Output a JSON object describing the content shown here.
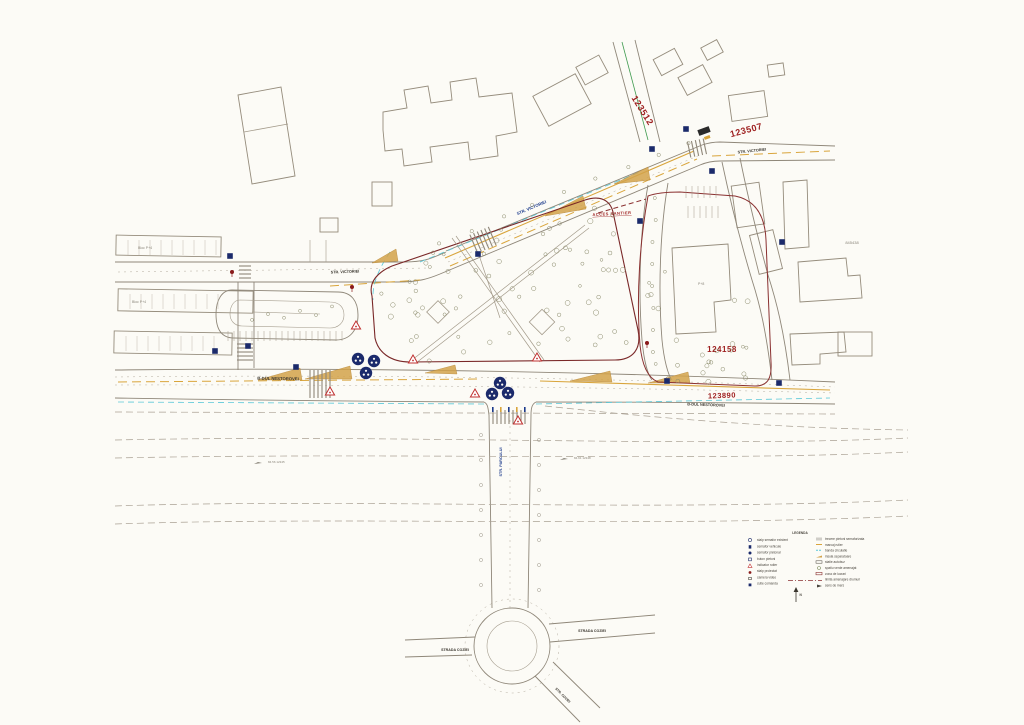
{
  "colors": {
    "paper": "#fcfbf6",
    "line_gray": "#8f8779",
    "parcel_red": "#9e2020",
    "boundary_red": "#8a3030",
    "street_blue": "#1b3a8b",
    "navy": "#1b2a6b",
    "marking_yellow": "#d9a53c",
    "island_tan": "#d2a24a",
    "aux_cyan": "#5bc8d8",
    "aux_green": "#3f9b4f"
  },
  "parcels": {
    "p123512": "123512",
    "p123507": "123507",
    "p124158": "124158",
    "p123890": "123890",
    "p845438": "845438"
  },
  "streets": {
    "victoriei_diag": "STR. VICTORIEI",
    "victoriei_top": "STR. VICTORIEI",
    "victoriei_left": "STR. VICTORIEI",
    "nestorovei_w": "B-DUL NESTOROVEI",
    "nestorovei_e": "B-DUL NESTOROVEI",
    "parcului": "STR. PARCULUI",
    "coziei_w": "STRADA COZIEI",
    "coziei_e": "STRADA COZIEI",
    "coziei_se": "STR. COZIEI"
  },
  "notes": {
    "acces": "ACCES SANTIER",
    "bloc_a": "Bloc P+4",
    "bloc_b": "Bloc P+4",
    "bloc_c": "P+8",
    "elev_w": "84.56 12345",
    "elev_e": "84.61 12348"
  },
  "legend": {
    "title": "LEGENDA",
    "left": [
      "stalp semafor existent",
      "semafor vehicule",
      "semafor pietonal",
      "buton pietoni",
      "indicator rutier",
      "stalp proiectat",
      "camera video",
      "cutie comanda"
    ],
    "right": [
      "trecere pietoni semaforizata",
      "marcaj rutier",
      "banda circulatie",
      "insula separatoare",
      "statie autobuz",
      "spatiu verde amenajat",
      "zona de lucrari",
      "limita amenajare drumuri",
      "sens de mers"
    ],
    "north": "N"
  }
}
